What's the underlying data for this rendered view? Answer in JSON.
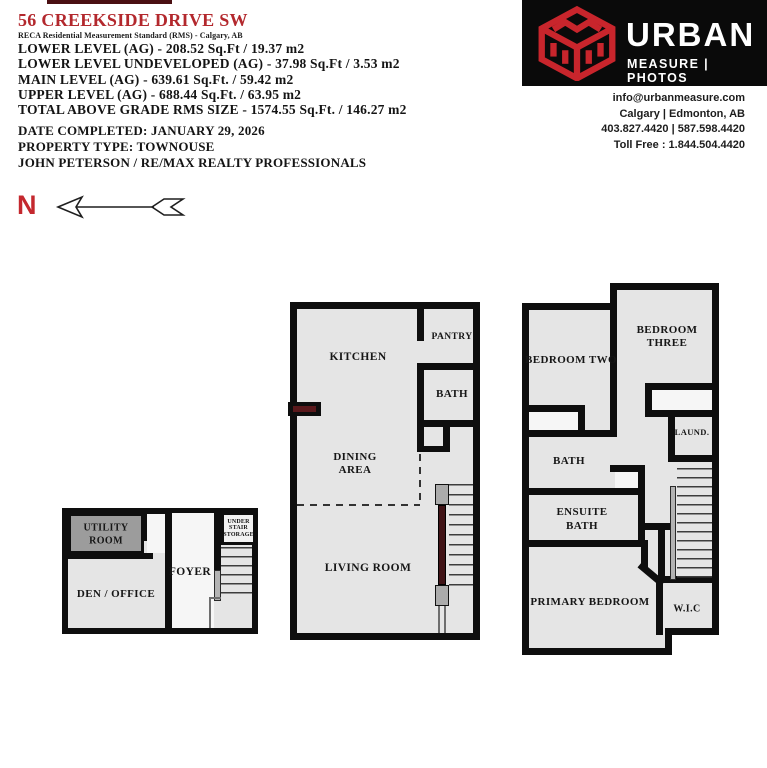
{
  "header": {
    "address": "56 CREEKSIDE DRIVE SW",
    "standard_line": "RECA Residential Measurement Standard (RMS) - Calgary, AB",
    "measurement_lines": [
      "LOWER LEVEL (AG) - 208.52 Sq.Ft / 19.37 m2",
      "LOWER LEVEL UNDEVELOPED (AG) - 37.98 Sq.Ft / 3.53 m2",
      "MAIN LEVEL (AG) - 639.61 Sq.Ft. / 59.42 m2",
      "UPPER LEVEL (AG) - 688.44 Sq.Ft. / 63.95 m2",
      "TOTAL ABOVE GRADE RMS SIZE - 1574.55 Sq.Ft. / 146.27 m2"
    ],
    "date_completed": "DATE COMPLETED: JANUARY 29, 2026",
    "property_type": "PROPERTY TYPE: TOWNOUSE",
    "agent_line": "JOHN PETERSON / RE/MAX REALTY PROFESSIONALS",
    "accent_color": "#b3282d"
  },
  "brand": {
    "name_top": "URBAN",
    "name_bottom": "MEASURE | PHOTOS",
    "email": "info@urbanmeasure.com",
    "locations": "Calgary | Edmonton, AB",
    "phones": "403.827.4420 | 587.598.4420",
    "toll_free": "Toll Free : 1.844.504.4420",
    "logo_red": "#c8252c",
    "logo_bg": "#0a0a0a"
  },
  "compass": {
    "north_label": "N"
  },
  "plans": {
    "lower_level": {
      "utility_line1": "UTILITY",
      "utility_line2": "ROOM",
      "den_office": "DEN / OFFICE",
      "foyer": "FOYER",
      "under_stair_line1": "UNDER",
      "under_stair_line2": "STAIR",
      "under_stair_line3": "STORAGE"
    },
    "main_level": {
      "kitchen": "KITCHEN",
      "pantry": "PANTRY",
      "bath": "BATH",
      "dining_line1": "DINING",
      "dining_line2": "AREA",
      "living_room": "LIVING ROOM"
    },
    "upper_level": {
      "bedroom_two": "BEDROOM TWO",
      "bedroom_three_line1": "BEDROOM",
      "bedroom_three_line2": "THREE",
      "laundry": "LAUND.",
      "bath": "BATH",
      "ensuite_line1": "ENSUITE",
      "ensuite_line2": "BATH",
      "primary_bedroom": "PRIMARY BEDROOM",
      "wic": "W.I.C"
    }
  }
}
